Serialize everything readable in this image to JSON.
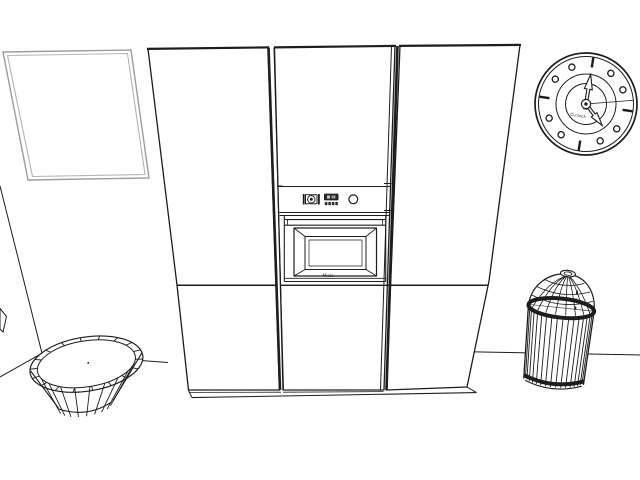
{
  "scene": {
    "background": "#ffffff",
    "ink": "#1d1d1d",
    "frame_stroke": "#9c9c9c",
    "objects": {
      "picture_frame": {
        "label": "Empty picture frame on wall"
      },
      "left_cabinet": {
        "label": "Tall cabinet left"
      },
      "middle_cabinet": {
        "label": "Tall oven housing cabinet"
      },
      "right_cabinet": {
        "label": "Tall cabinet right"
      },
      "oven": {
        "label": "Built-in oven",
        "brand": "Miele"
      },
      "clock": {
        "label": "Wall clock",
        "dial_text": "O-clock",
        "time_shown": "5:00"
      },
      "bowl": {
        "label": "Oval ribbed bowl on floor"
      },
      "trash_can": {
        "label": "Dome-lid trash can"
      }
    },
    "gen": {
      "clock_markers": {
        "count": 12,
        "dash_every": 3,
        "r_circle": 39.5,
        "circle_size": 3.1,
        "dash_r1": 37,
        "dash_r2": 47
      },
      "bowl": {
        "ticks": 18,
        "ribs": 9
      },
      "can": {
        "ribs": 16
      },
      "dome": {
        "longitudes": 8,
        "latitudes": [
          [
            10,
            6
          ],
          [
            19,
            5
          ],
          [
            27,
            4
          ]
        ]
      }
    }
  }
}
